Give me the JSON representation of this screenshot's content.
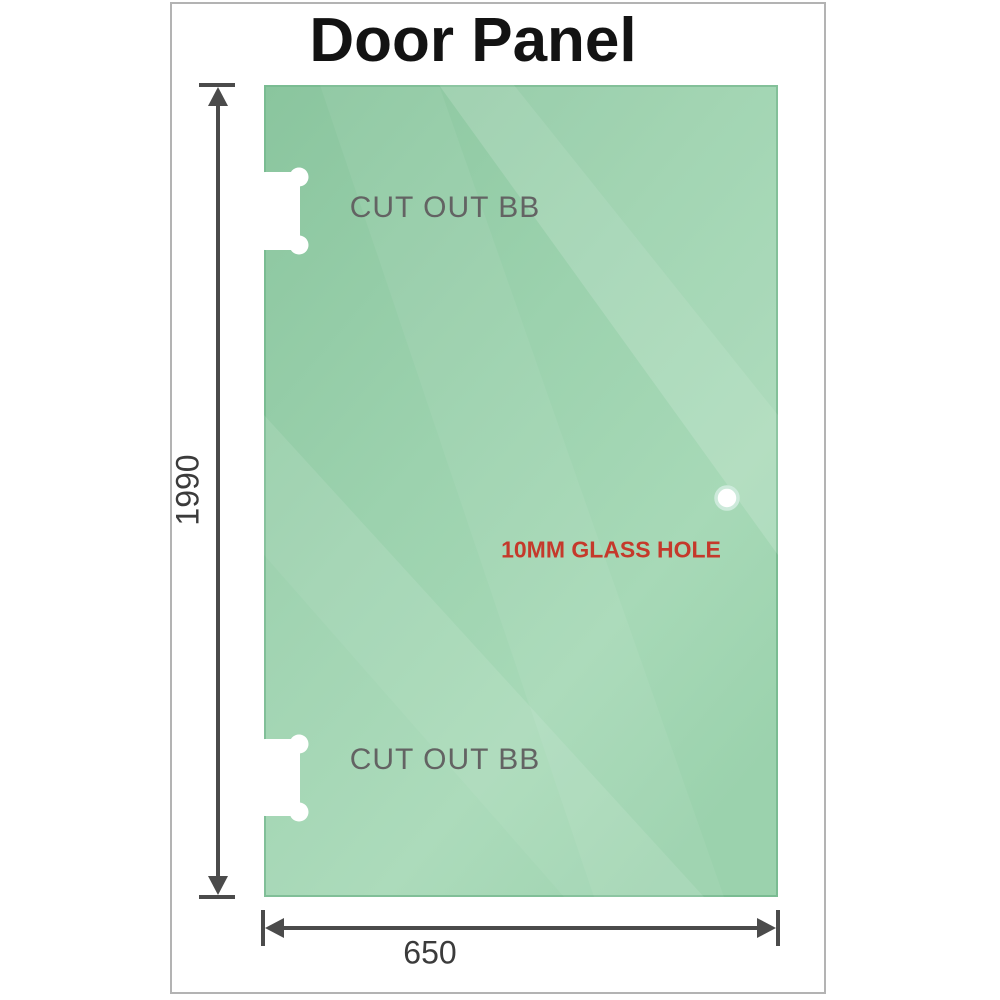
{
  "title": "Door Panel",
  "panel": {
    "glass_color": "#9cd2ae",
    "cutouts": [
      {
        "label": "CUT OUT BB",
        "position": "top-left"
      },
      {
        "label": "CUT OUT BB",
        "position": "bottom-left"
      }
    ],
    "hole": {
      "label": "10MM GLASS HOLE",
      "label_color": "#c5392b"
    }
  },
  "dimensions": {
    "height": {
      "value": "1990",
      "side": "left"
    },
    "width": {
      "value": "650",
      "side": "bottom"
    }
  },
  "colors": {
    "frame_border": "#b3b3b3",
    "dimension_line": "#4b4b4b",
    "dimension_text": "#3b3b3b",
    "cutout_label_text": "#636363",
    "title_text": "#131313",
    "background": "#ffffff"
  }
}
